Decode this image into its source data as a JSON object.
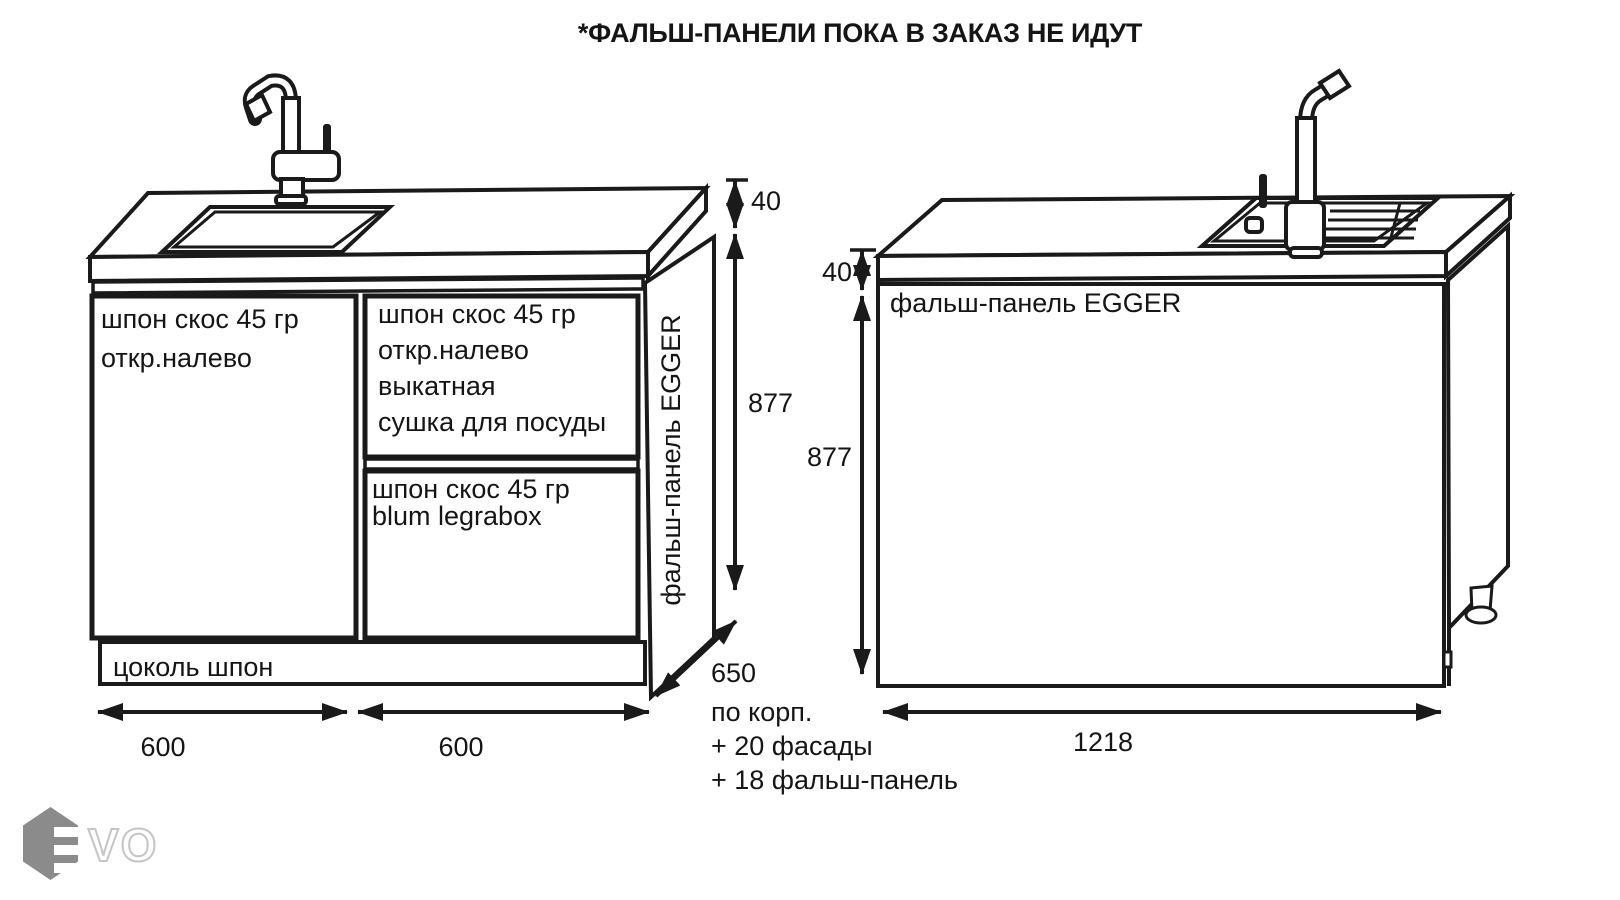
{
  "title": "*ФАЛЬШ-ПАНЕЛИ ПОКА В ЗАКАЗ НЕ ИДУТ",
  "left_cabinet": {
    "left_door": {
      "line1": "шпон скос 45 гр",
      "line2": "откр.налево"
    },
    "right_door": {
      "line1": "шпон скос 45 гр",
      "line2": "откр.налево",
      "line3": "выкатная",
      "line4": "сушка для посуды"
    },
    "drawer": {
      "line1": "шпон скос 45 гр",
      "line2": "blum legrabox"
    },
    "plinth": "цоколь шпон",
    "side_panel": "фальш-панель EGGER",
    "dims": {
      "countertop_thickness": "40",
      "height": "877",
      "depth": "650",
      "width_left_module": "600",
      "width_right_module": "600"
    },
    "depth_note": {
      "line1": "по корп.",
      "line2": "+ 20 фасады",
      "line3": "+ 18 фальш-панель"
    }
  },
  "right_cabinet": {
    "front_panel": "фальш-панель EGGER",
    "dims": {
      "countertop_thickness": "40",
      "height": "877",
      "width": "1218"
    }
  },
  "logo": {
    "letters": "VO"
  },
  "colors": {
    "line": "#1a1a1a",
    "logo_hexagon": "#8b8b8b",
    "logo_outline": "#c5c5c5"
  }
}
